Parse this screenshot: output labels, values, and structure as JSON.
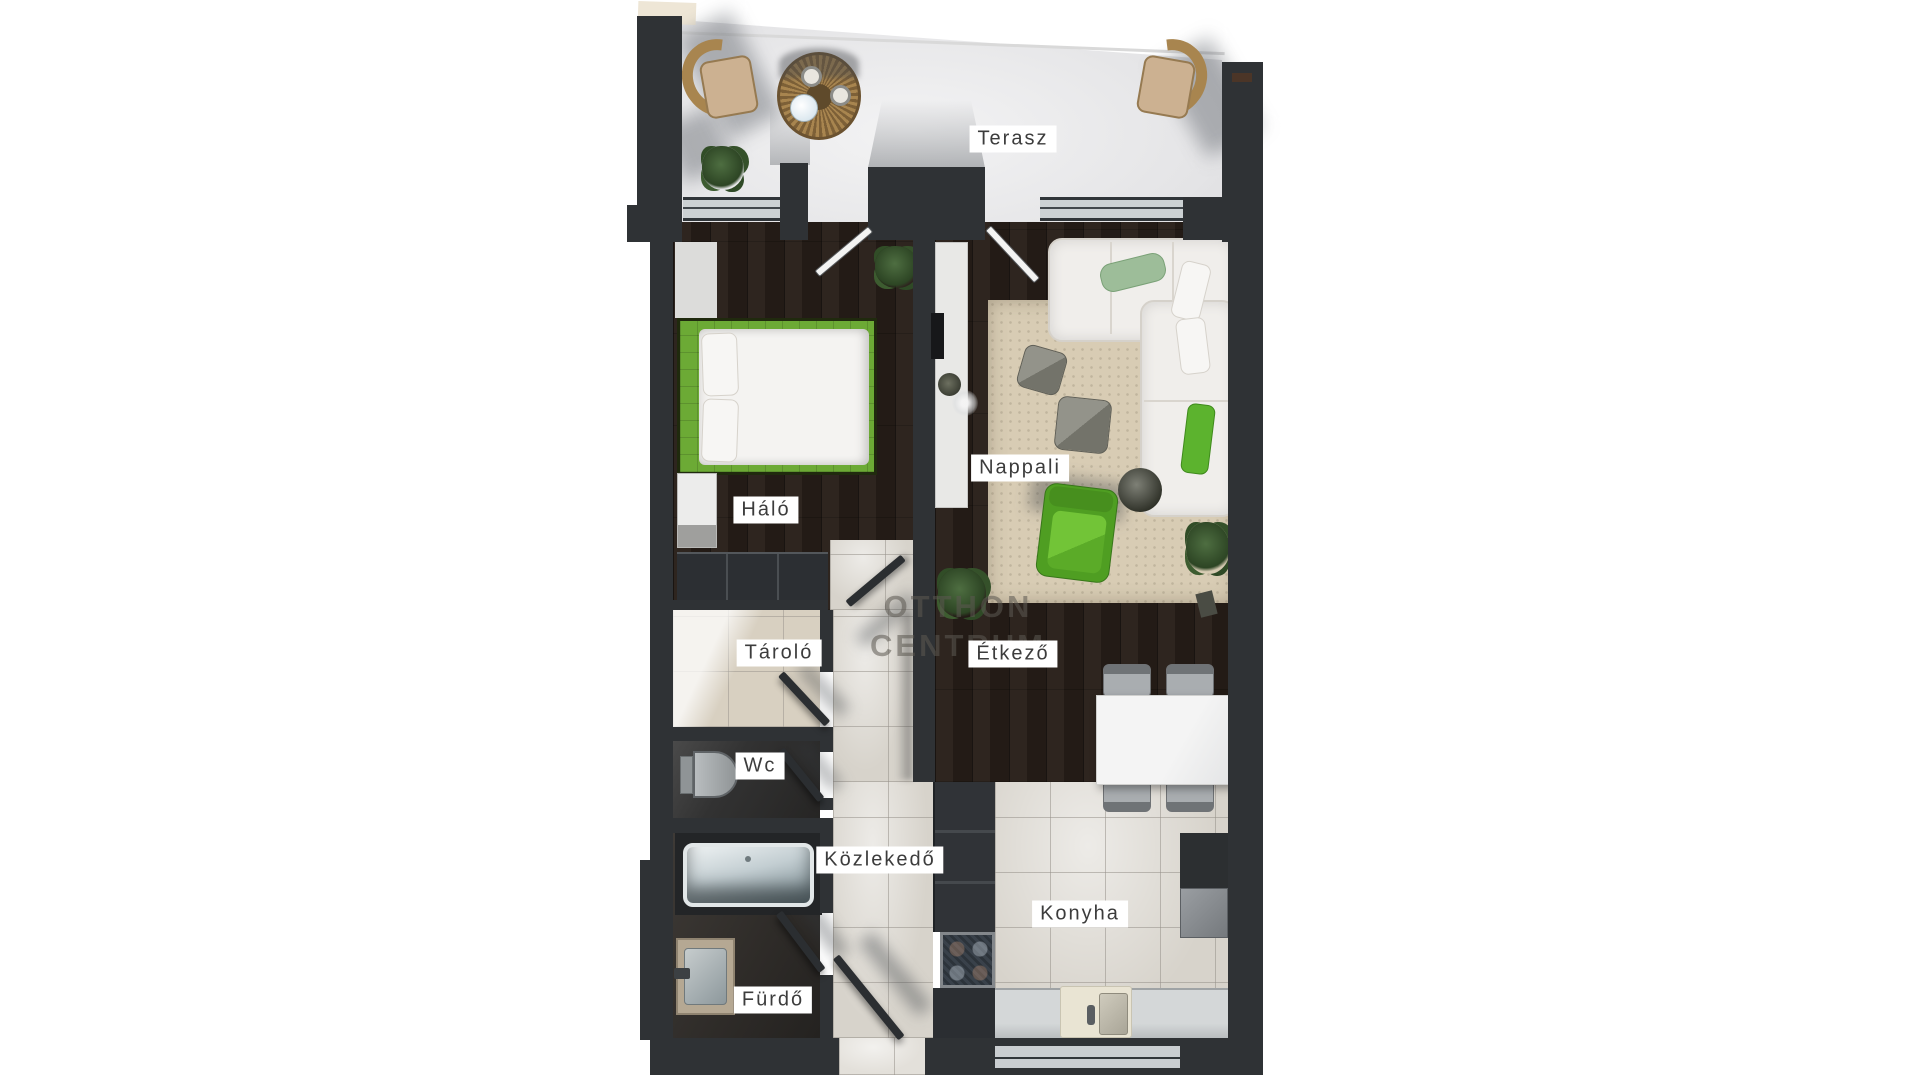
{
  "plan": {
    "watermark": {
      "line1": "OTTHON",
      "line2": "CENTRUM"
    },
    "rooms": [
      {
        "id": "terasz",
        "label": "Terasz"
      },
      {
        "id": "halo",
        "label": "Háló"
      },
      {
        "id": "nappali",
        "label": "Nappali"
      },
      {
        "id": "tarolo",
        "label": "Tároló"
      },
      {
        "id": "etkezo",
        "label": "Étkező"
      },
      {
        "id": "wc",
        "label": "Wc"
      },
      {
        "id": "kozlekedo",
        "label": "Közlekedő"
      },
      {
        "id": "konyha",
        "label": "Konyha"
      },
      {
        "id": "furdo",
        "label": "Fürdő"
      }
    ],
    "colors": {
      "wall": "#2f3235",
      "wood_floor": "#271e18",
      "tile_floor": "#d7d3cb",
      "terrace_floor": "#e9e9ea",
      "accent_green": "#5fae2b",
      "bed_green": "#6caa35",
      "rug": "#d8ccb4",
      "sofa": "#f0eeeb",
      "label_bg": "#ffffff",
      "label_text": "#3c3c3c",
      "watermark_text": "#5d5952"
    }
  }
}
